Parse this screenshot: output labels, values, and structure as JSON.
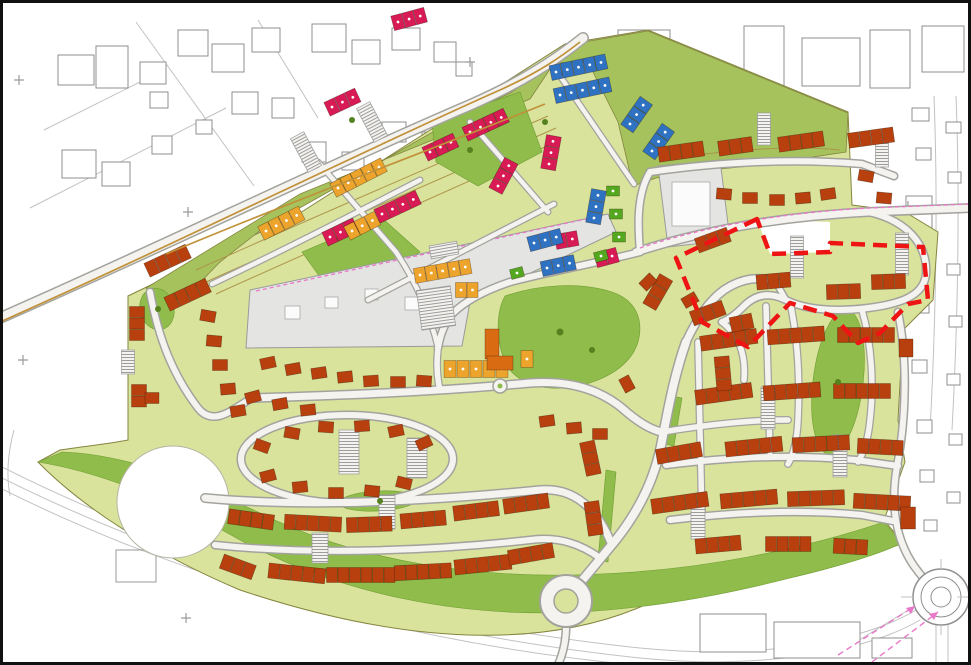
{
  "palette": {
    "plot_green": "#d9e39c",
    "open_green": "#8fbc4a",
    "band_green": "#a5c25d",
    "road_fill": "#f4f3f0",
    "road_casing": "#a3a39e",
    "context_gray": "#8f8f8f",
    "gray_parcel": "#e4e4e2",
    "house_terracotta": "#b8400e",
    "house_crimson": "#d81a55",
    "house_blue": "#2f72c2",
    "house_orange": "#eda42c",
    "house_dark_orange": "#d96b12",
    "house_green": "#54a81f",
    "boundary_red": "#ee1414",
    "pink_line": "#e878c8",
    "tan_line": "#c09138",
    "pond_white": "#ffffff"
  },
  "map": {
    "red_boundary_points": "757,219 676,258 702,322 748,347 790,303 833,316 858,343 880,333 908,304 928,300 923,247 830,243 830,252 770,254",
    "roundabouts": 3,
    "house_rows": [
      [
        "cr",
        398,
        22,
        -15,
        3
      ],
      [
        "cr",
        332,
        107,
        -25,
        3
      ],
      [
        "cr",
        470,
        132,
        -25,
        4
      ],
      [
        "cr",
        430,
        152,
        -25,
        3
      ],
      [
        "cr",
        382,
        214,
        -25,
        4
      ],
      [
        "cr",
        330,
        237,
        -25,
        3
      ],
      [
        "cr",
        498,
        186,
        -62,
        3
      ],
      [
        "cr",
        549,
        164,
        -80,
        3
      ],
      [
        "cr",
        561,
        241,
        -10,
        2
      ],
      [
        "cr",
        601,
        259,
        -15,
        2
      ],
      [
        "bl",
        556,
        72,
        -12,
        5
      ],
      [
        "bl",
        560,
        95,
        -12,
        5
      ],
      [
        "bl",
        630,
        124,
        -55,
        3
      ],
      [
        "bl",
        652,
        151,
        -55,
        3
      ],
      [
        "bl",
        594,
        218,
        -80,
        3
      ],
      [
        "bl",
        534,
        243,
        -15,
        3
      ],
      [
        "bl",
        547,
        268,
        -12,
        3
      ],
      [
        "or",
        338,
        188,
        -27,
        5
      ],
      [
        "or",
        352,
        231,
        -27,
        3
      ],
      [
        "or",
        420,
        275,
        -10,
        5
      ],
      [
        "or",
        266,
        231,
        -27,
        4
      ],
      [
        "or",
        461,
        290,
        0,
        2
      ],
      [
        "gr",
        613,
        191,
        0,
        1,
        13,
        10
      ],
      [
        "gr",
        616,
        214,
        0,
        1,
        13,
        10
      ],
      [
        "gr",
        619,
        237,
        0,
        1,
        13,
        10
      ],
      [
        "gr",
        601,
        256,
        -15,
        1,
        13,
        10
      ],
      [
        "gr",
        517,
        273,
        -15,
        1,
        13,
        10
      ],
      [
        "tc",
        152,
        268,
        -25,
        4
      ],
      [
        "tc",
        172,
        302,
        -25,
        4
      ],
      [
        "tc",
        137,
        312,
        90,
        3
      ],
      [
        "tc",
        139,
        390,
        90,
        2
      ],
      [
        "tc",
        152,
        398,
        0,
        1,
        14,
        11
      ],
      [
        "tc",
        208,
        316,
        10,
        1,
        15,
        11
      ],
      [
        "tc",
        214,
        341,
        5,
        1,
        15,
        11
      ],
      [
        "tc",
        220,
        365,
        0,
        1,
        15,
        11
      ],
      [
        "tc",
        228,
        389,
        -5,
        1,
        15,
        11
      ],
      [
        "tc",
        238,
        411,
        -10,
        1,
        15,
        11
      ],
      [
        "tc",
        268,
        363,
        -12,
        1,
        15,
        11
      ],
      [
        "tc",
        293,
        369,
        -10,
        1,
        15,
        11
      ],
      [
        "tc",
        319,
        373,
        -8,
        1,
        15,
        11
      ],
      [
        "tc",
        345,
        377,
        -6,
        1,
        15,
        11
      ],
      [
        "tc",
        371,
        381,
        -4,
        1,
        15,
        11
      ],
      [
        "tc",
        398,
        382,
        0,
        1,
        15,
        11
      ],
      [
        "tc",
        424,
        381,
        4,
        1,
        15,
        11
      ],
      [
        "tc",
        253,
        397,
        -15,
        1,
        15,
        11
      ],
      [
        "tc",
        280,
        404,
        -10,
        1,
        15,
        11
      ],
      [
        "tc",
        308,
        410,
        -6,
        1,
        15,
        11
      ],
      [
        "or",
        450,
        369,
        0,
        5,
        12,
        17,
        13
      ],
      [
        "do",
        492,
        344,
        0,
        1,
        14,
        30
      ],
      [
        "do",
        500,
        363,
        0,
        1,
        26,
        14
      ],
      [
        "or",
        527,
        359,
        0,
        1,
        12,
        17
      ],
      [
        "tc",
        547,
        421,
        -8,
        1,
        15,
        11
      ],
      [
        "tc",
        574,
        428,
        -5,
        1,
        15,
        11
      ],
      [
        "tc",
        600,
        434,
        0,
        1,
        15,
        11
      ],
      [
        "tc",
        262,
        446,
        20,
        1,
        15,
        11
      ],
      [
        "tc",
        292,
        433,
        10,
        1,
        15,
        11
      ],
      [
        "tc",
        326,
        427,
        4,
        1,
        15,
        11
      ],
      [
        "tc",
        362,
        426,
        -4,
        1,
        15,
        11
      ],
      [
        "tc",
        396,
        431,
        -12,
        1,
        15,
        11
      ],
      [
        "tc",
        424,
        443,
        -25,
        1,
        15,
        11
      ],
      [
        "tc",
        268,
        476,
        -15,
        1,
        15,
        11
      ],
      [
        "tc",
        300,
        487,
        -6,
        1,
        15,
        11
      ],
      [
        "tc",
        336,
        493,
        0,
        1,
        15,
        11
      ],
      [
        "tc",
        372,
        491,
        6,
        1,
        15,
        11
      ],
      [
        "tc",
        404,
        483,
        14,
        1,
        15,
        11
      ],
      [
        "tc",
        234,
        517,
        8,
        4
      ],
      [
        "tc",
        290,
        522,
        3,
        5
      ],
      [
        "tc",
        352,
        525,
        -2,
        4
      ],
      [
        "tc",
        406,
        521,
        -5,
        4
      ],
      [
        "tc",
        459,
        513,
        -7,
        4
      ],
      [
        "tc",
        509,
        506,
        -8,
        4
      ],
      [
        "tc",
        227,
        563,
        20,
        3
      ],
      [
        "tc",
        274,
        571,
        6,
        5
      ],
      [
        "tc",
        332,
        575,
        0,
        6
      ],
      [
        "tc",
        400,
        573,
        -3,
        5
      ],
      [
        "tc",
        460,
        567,
        -6,
        5
      ],
      [
        "tc",
        514,
        557,
        -10,
        4
      ],
      [
        "tc",
        588,
        447,
        78,
        3
      ],
      [
        "tc",
        592,
        507,
        82,
        3
      ],
      [
        "tc",
        706,
        343,
        -8,
        5
      ],
      [
        "tc",
        773,
        337,
        -4,
        5
      ],
      [
        "tc",
        843,
        335,
        0,
        5
      ],
      [
        "tc",
        701,
        397,
        -8,
        5
      ],
      [
        "tc",
        769,
        393,
        -4,
        5
      ],
      [
        "tc",
        839,
        391,
        0,
        5
      ],
      [
        "tc",
        662,
        456,
        -10,
        4
      ],
      [
        "tc",
        731,
        449,
        -6,
        5
      ],
      [
        "tc",
        798,
        445,
        -3,
        5
      ],
      [
        "tc",
        863,
        446,
        3,
        4
      ],
      [
        "tc",
        657,
        506,
        -8,
        5
      ],
      [
        "tc",
        726,
        501,
        -5,
        5
      ],
      [
        "tc",
        793,
        499,
        -2,
        5
      ],
      [
        "tc",
        859,
        501,
        3,
        5
      ],
      [
        "tc",
        701,
        546,
        -5,
        4
      ],
      [
        "tc",
        771,
        544,
        0,
        4
      ],
      [
        "tc",
        839,
        546,
        3,
        3
      ],
      [
        "tc",
        906,
        348,
        0,
        1,
        14,
        18
      ],
      [
        "tc",
        908,
        518,
        0,
        1,
        15,
        22
      ],
      [
        "tc",
        652,
        302,
        -60,
        3
      ],
      [
        "tc",
        697,
        317,
        -20,
        3
      ],
      [
        "tc",
        736,
        324,
        -12,
        2
      ],
      [
        "tc",
        648,
        282,
        -45,
        1,
        15,
        11
      ],
      [
        "tc",
        722,
        362,
        85,
        3
      ],
      [
        "tc",
        627,
        384,
        62,
        1,
        15,
        11
      ],
      [
        "tc",
        664,
        154,
        -8,
        4
      ],
      [
        "tc",
        724,
        148,
        -8,
        3
      ],
      [
        "tc",
        784,
        144,
        -8,
        4
      ],
      [
        "tc",
        854,
        140,
        -8,
        4
      ],
      [
        "tc",
        724,
        194,
        5,
        1,
        15,
        11
      ],
      [
        "tc",
        750,
        198,
        0,
        1,
        15,
        11
      ],
      [
        "tc",
        777,
        200,
        0,
        1,
        15,
        11
      ],
      [
        "tc",
        803,
        198,
        -5,
        1,
        15,
        11
      ],
      [
        "tc",
        828,
        194,
        -8,
        1,
        15,
        11
      ],
      [
        "tc",
        866,
        176,
        10,
        1,
        15,
        11
      ],
      [
        "tc",
        884,
        198,
        5,
        1,
        15,
        11
      ],
      [
        "tc",
        702,
        244,
        -20,
        3
      ],
      [
        "tc",
        762,
        282,
        -5,
        3
      ],
      [
        "tc",
        832,
        292,
        -2,
        3
      ],
      [
        "tc",
        877,
        282,
        -2,
        3
      ],
      [
        "tc",
        690,
        300,
        -30,
        1,
        15,
        11
      ]
    ],
    "parking_courts": [
      [
        128,
        362,
        13,
        24,
        0
      ],
      [
        436,
        308,
        34,
        40,
        -8
      ],
      [
        349,
        452,
        20,
        44,
        0
      ],
      [
        417,
        458,
        20,
        40,
        0
      ],
      [
        320,
        548,
        16,
        30,
        0
      ],
      [
        387,
        512,
        16,
        34,
        0
      ],
      [
        698,
        520,
        14,
        38,
        0
      ],
      [
        768,
        408,
        14,
        42,
        0
      ],
      [
        840,
        456,
        14,
        42,
        0
      ],
      [
        902,
        254,
        13,
        42,
        0
      ],
      [
        797,
        257,
        13,
        42,
        0
      ],
      [
        764,
        129,
        13,
        32,
        0
      ],
      [
        882,
        151,
        13,
        32,
        0
      ],
      [
        306,
        152,
        15,
        38,
        -28
      ],
      [
        372,
        122,
        15,
        38,
        -28
      ],
      [
        444,
        250,
        28,
        13,
        -10
      ]
    ]
  }
}
